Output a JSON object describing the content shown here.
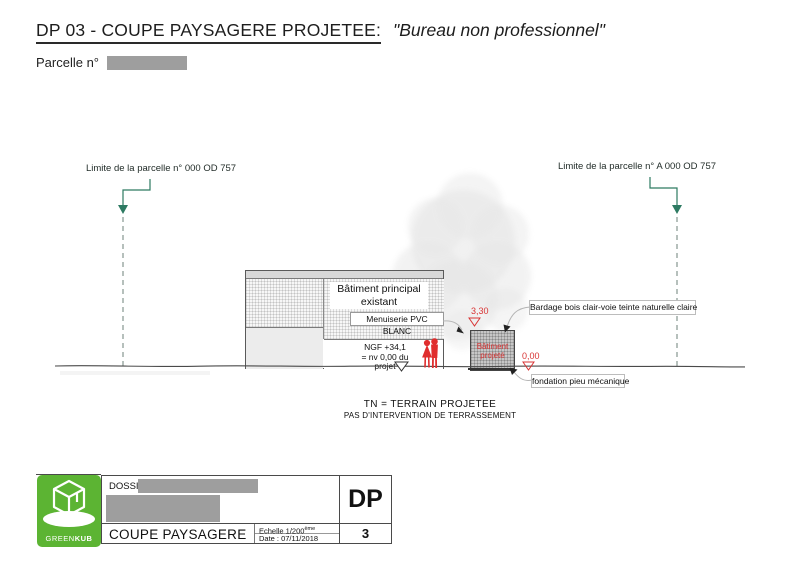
{
  "header": {
    "title_main": "DP 03 - COUPE PAYSAGERE PROJETEE:",
    "title_sub": "\"Bureau non professionnel\"",
    "parcel_label": "Parcelle n°"
  },
  "drawing": {
    "limit_left": "Limite de la parcelle n° 000 OD 757",
    "limit_right": "Limite de la parcelle n° A 000 OD 757",
    "existing_building": {
      "label_line1": "Bâtiment principal",
      "label_line2": "existant",
      "menuiserie": "Menuiserie PVC BLANC",
      "ngf_line1": "NGF +34,1",
      "ngf_line2": "= nv 0,00 du projet"
    },
    "projected_building": {
      "label_line1": "Bâtiment",
      "label_line2": "projeté",
      "level_top": "3,30",
      "level_ground": "0,00"
    },
    "bardage_label": "Bardage bois clair-voie teinte naturelle claire",
    "fondation_label": "fondation pieu mécanique",
    "tn_line1": "TN = TERRAIN PROJETEE",
    "tn_line2": "PAS D'INTERVENTION DE TERRASSEMENT"
  },
  "titleblock": {
    "dossier_label": "DOSSIER  M.",
    "drawing_title": "COUPE PAYSAGERE",
    "scale_prefix": "Echelle 1/200",
    "scale_sup": "ème",
    "date": "Date : 07/11/2018",
    "doc_type": "DP",
    "sheet_number": "3",
    "logo_text_light": "GREEN",
    "logo_text_bold": "KUB"
  },
  "colors": {
    "accent_green": "#5cb433",
    "marker_red": "#d83434",
    "arrow_teal": "#2d7a62",
    "redaction_gray": "#9e9e9e"
  }
}
